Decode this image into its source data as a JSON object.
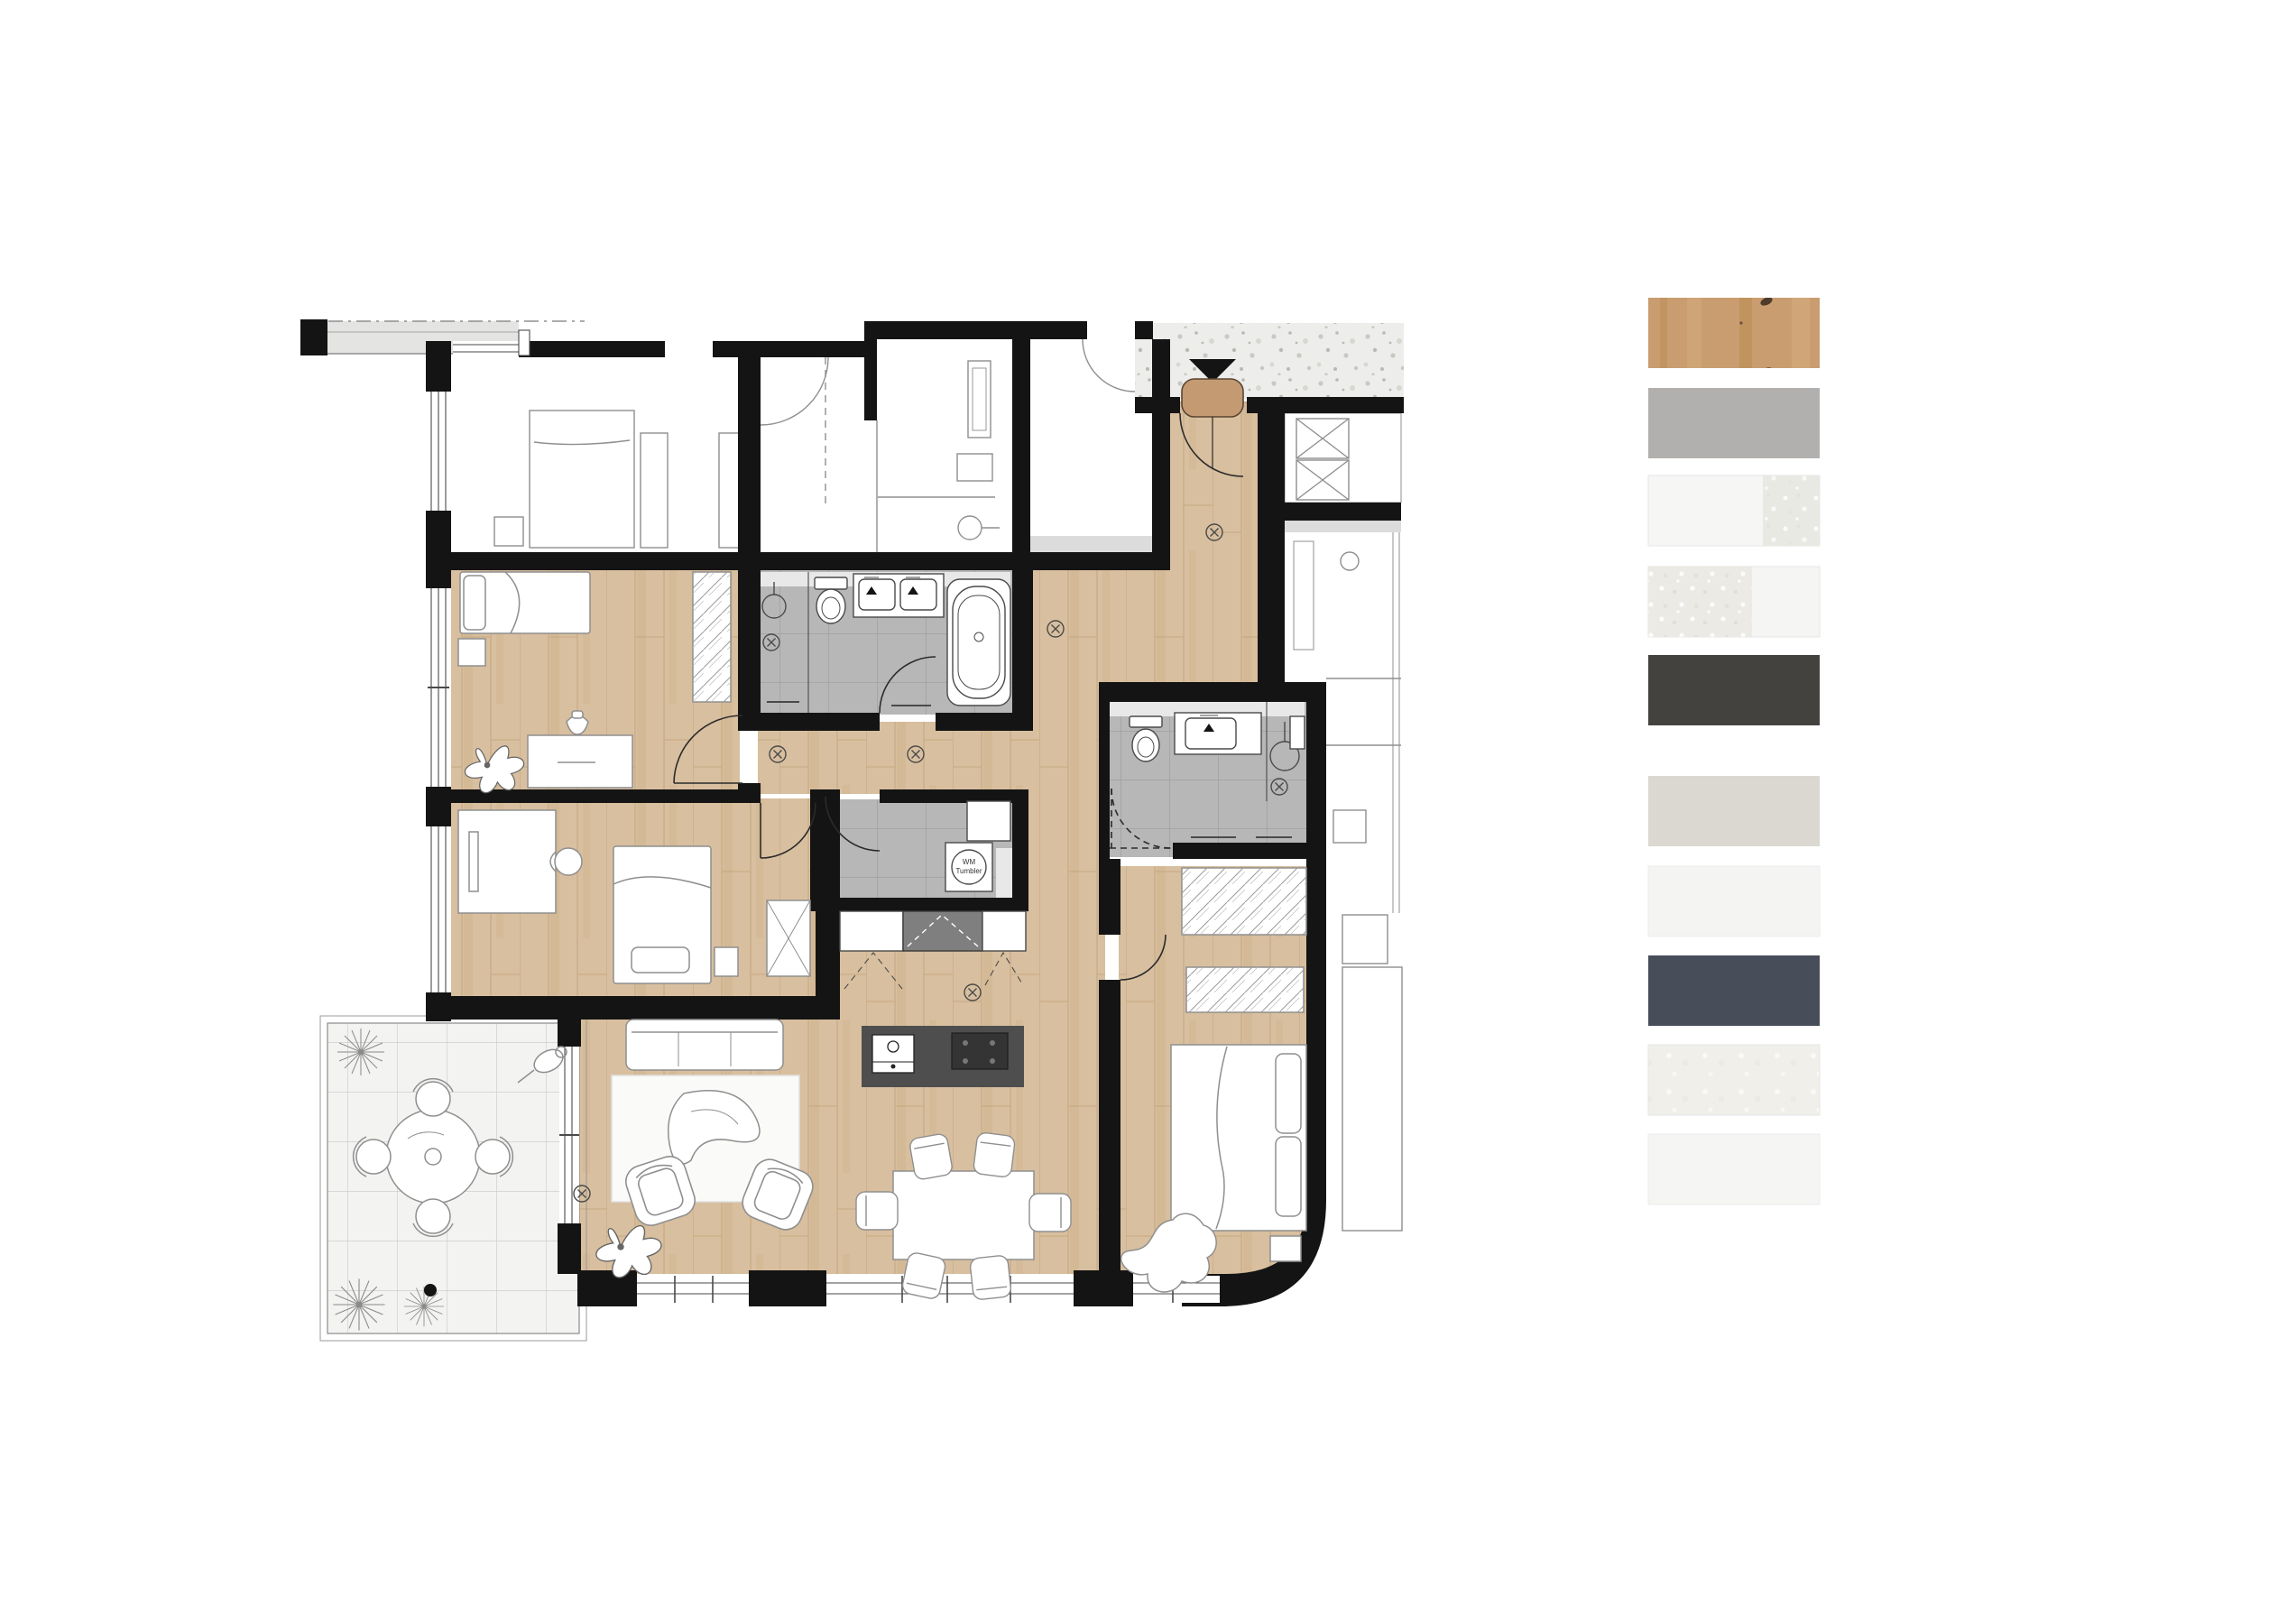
{
  "plan": {
    "washer_label_1": "WM",
    "washer_label_2": "Tumbler"
  },
  "colors": {
    "wall": "#141414",
    "wood": "#d8bf9f",
    "wood_grain": "#c6a87f",
    "wood_streak": "#cdb18a",
    "entry_door": "#c49a73",
    "tile": "#b7b7b7",
    "tile_line": "#9c9c9c",
    "band": "#e8e8e8",
    "gray_band": "#dcdcdc",
    "loggia": "#e4e4e2",
    "neighbor_stroke": "#8f8f8f",
    "fixture_stroke": "#4a4a4a",
    "door_stroke": "#2b2b2b",
    "island": "#4e4e4e",
    "cooktop": "#343434",
    "counter_dark": "#7f7f7f",
    "terrace": "#f3f3f1",
    "terrace_line": "#c9c9c9",
    "terrazzo": "#ededeb",
    "terrazzo_dot1": "#c9c9c3",
    "terrazzo_dot2": "#b9bab2",
    "terrazzo_dot3": "#d8d8d2",
    "rug": "#fafaf8",
    "white": "#ffffff"
  },
  "swatches": [
    {
      "color": "#c99d6f",
      "grain": "#b8894f",
      "grain2": "#dab585"
    },
    {
      "color": "#b2b0ae"
    },
    {
      "color": "#f6f6f5",
      "color2": "#e9e9e4"
    },
    {
      "color": "#eceae4",
      "color2": "#f5f5f4"
    },
    {
      "color": "#44423e"
    },
    {
      "color": "#dad8d1"
    },
    {
      "color": "#f4f4f3"
    },
    {
      "color": "#474d59"
    },
    {
      "color": "#f0efe9"
    },
    {
      "color": "#f5f5f4"
    }
  ]
}
